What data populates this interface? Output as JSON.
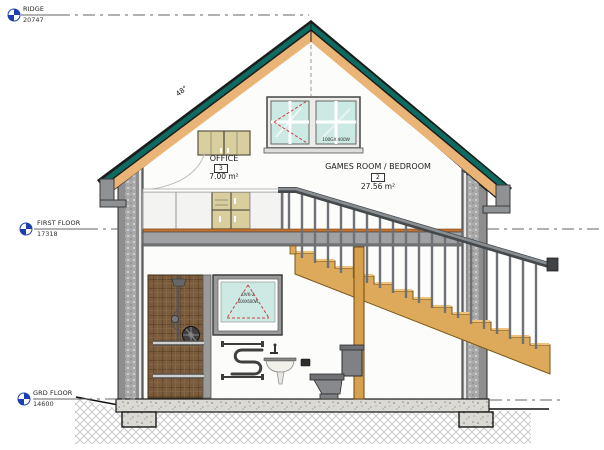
{
  "levels": [
    {
      "name": "RIDGE",
      "elevation": "20747"
    },
    {
      "name": "FIRST FLOOR",
      "elevation": "17318"
    },
    {
      "name": "GRD FLOOR",
      "elevation": "14600"
    }
  ],
  "rooms": {
    "games": {
      "name": "GAMES ROOM / BEDROOM",
      "number": "2",
      "area": "27.56 m²"
    },
    "office": {
      "name": "OFFICE",
      "number": "3",
      "area": "7.00 m²"
    }
  },
  "roof": {
    "pitch_label": "48°"
  },
  "windows": {
    "gable_tag": "100GX 400W",
    "bath_tag_line1": "OV6-2",
    "bath_tag_line2": "600X600W"
  },
  "colors": {
    "roof_teal": "#0E6B5F",
    "roof_timber": "#EAB476",
    "stair_timber": "#DCA85C",
    "level_marker_blue": "#1C3FAE",
    "glass": "#CDE9E3",
    "opening_red": "#CC4444",
    "tile_brown": "#7A5C3C"
  }
}
